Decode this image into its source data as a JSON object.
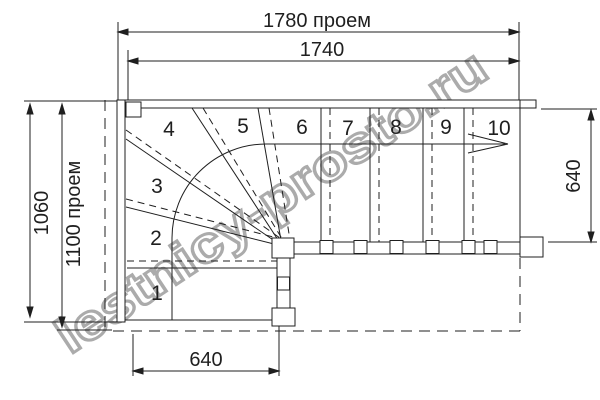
{
  "watermark": {
    "text": "lestnicy-prosto.ru"
  },
  "dimensions": {
    "top_opening": "1780 проем",
    "top_inner": "1740",
    "left_height": "1060",
    "left_opening": "1100 проем",
    "right_width": "640",
    "bottom_width": "640"
  },
  "steps": [
    "1",
    "2",
    "3",
    "4",
    "5",
    "6",
    "7",
    "8",
    "9",
    "10"
  ],
  "colors": {
    "line": "#1f1f1f",
    "watermark_outline": "#ababab",
    "background": "#ffffff"
  }
}
